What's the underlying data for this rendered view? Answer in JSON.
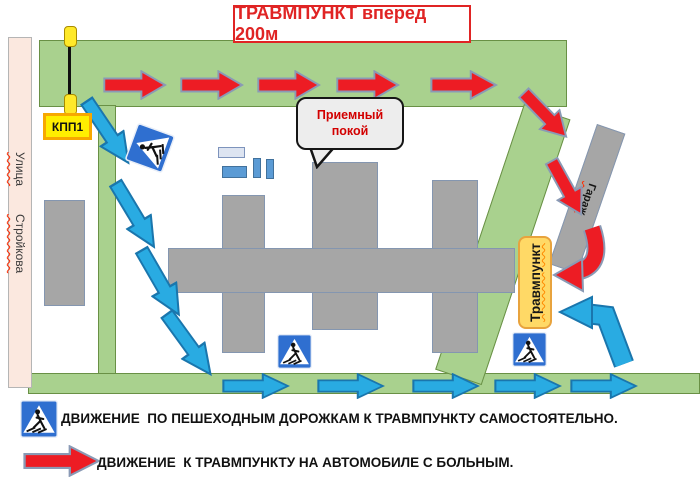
{
  "title": "ТРАВМПУНКТ вперед 200м",
  "street": {
    "line1": "Улица",
    "line2": "Стройкова"
  },
  "checkpoint": {
    "label": "КПП1"
  },
  "reception_callout": {
    "line1": "Приемный",
    "line2": "покой"
  },
  "trauma_center_label": "Травмпункт",
  "garage_label": "Гараж",
  "legend": {
    "pedestrian_text": "ДВИЖЕНИЕ  ПО ПЕШЕХОДНЫМ ДОРОЖКАМ К ТРАВМПУНКТУ САМОСТОЯТЕЛЬНО.",
    "car_text": "ДВИЖЕНИЕ  К ТРАВМПУНКТУ НА АВТОМОБИЛЕ С БОЛЬНЫМ."
  },
  "icons": {
    "pedestrian_crossing_sign": "pedestrian-crossing-sign-icon",
    "car_route_arrow": "red-arrow-icon",
    "pedestrian_route_arrow": "blue-arrow-icon",
    "barrier": "boom-barrier-icon"
  },
  "colors": {
    "car_route": "#ed1c24",
    "pedestrian_route": "#29abe2",
    "road": "#a9d18e",
    "building": "#a6a6a6",
    "street_strip": "#fbe8df",
    "checkpoint_fill": "#ffee00",
    "trauma_label_fill": "#ffd966",
    "title_accent": "#e02424",
    "sign_blue": "#2f6fd0"
  }
}
